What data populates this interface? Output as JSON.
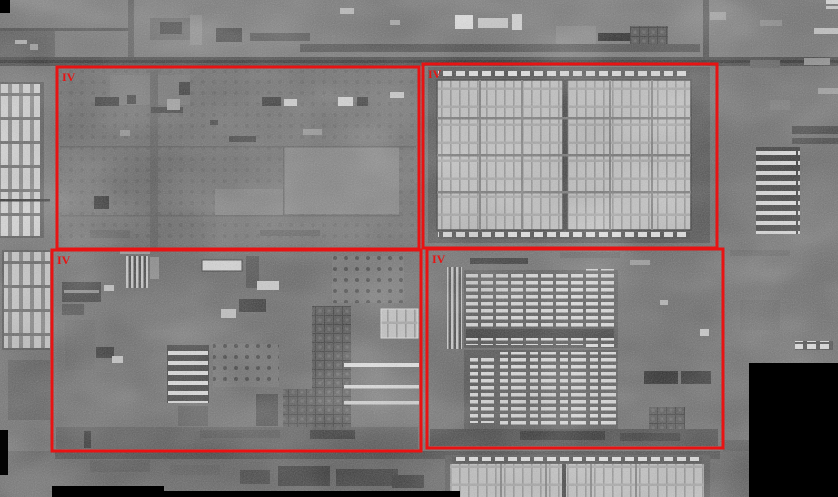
{
  "figure": {
    "kind": "grayscale-satellite-mosaic-with-annotations"
  },
  "palette": {
    "annotation_red": "#e81313",
    "base_gray": "#636363",
    "bright_structure": "#c3c3c3",
    "nodata_black": "#000000"
  },
  "regions": [
    {
      "label": "IV",
      "x": 57,
      "y": 67,
      "w": 362,
      "h": 182
    },
    {
      "label": "IV",
      "x": 423,
      "y": 64,
      "w": 294,
      "h": 184
    },
    {
      "label": "IV",
      "x": 52,
      "y": 250,
      "w": 369,
      "h": 201
    },
    {
      "label": "IV",
      "x": 427,
      "y": 249,
      "w": 296,
      "h": 199
    }
  ]
}
